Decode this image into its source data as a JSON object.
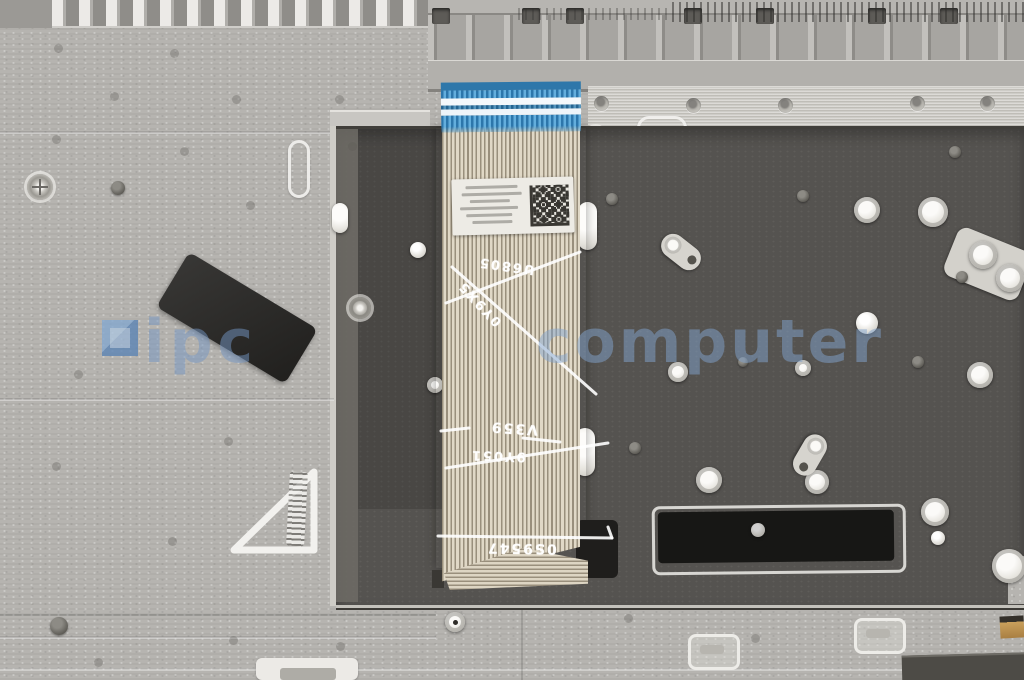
{
  "watermark": {
    "logo_icon": "ipc-computer-logo",
    "text_ipc": "ipc",
    "text_computer": "computer",
    "color": "#6e96c4"
  },
  "cable": {
    "handwritten_marks": {
      "mark_1": "U6805",
      "mark_2": "0Y9X5",
      "mark_3": "V359",
      "mark_4": "9Y051",
      "mark_5": "0S9547"
    }
  },
  "colors": {
    "palmrest_gray": "#b6b4b0",
    "backplate_dark": "#555350",
    "ribbon_beige": "#cdc4b2",
    "connector_blue": "#4a9ed2",
    "sticker_black": "#2b2a28",
    "watermark_blue": "#6e96c4"
  }
}
